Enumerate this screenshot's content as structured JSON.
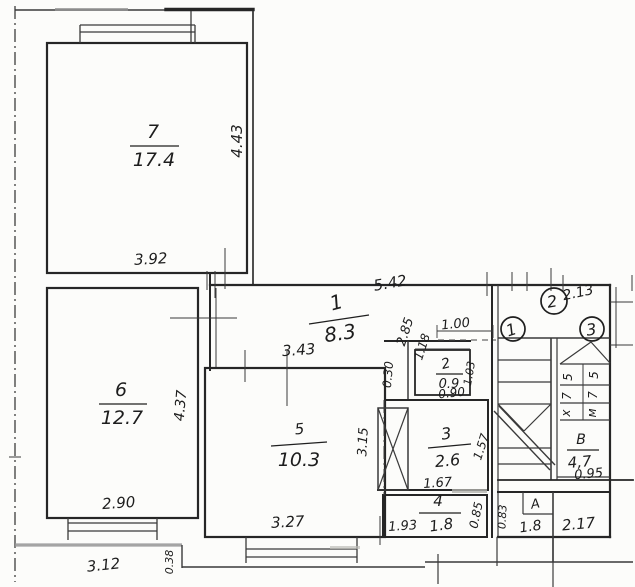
{
  "plan": {
    "type": "scanned hand-drawn apartment floor plan",
    "rooms": [
      {
        "number": "7",
        "area": "17.4"
      },
      {
        "number": "6",
        "area": "12.7"
      },
      {
        "number": "5",
        "area": "10.3"
      },
      {
        "number": "1",
        "area": "8.3"
      },
      {
        "number": "2",
        "area": "0.9"
      },
      {
        "number": "3",
        "area": "2.6"
      },
      {
        "number": "4",
        "area": "1.8"
      },
      {
        "number": "В",
        "area": "4,7"
      },
      {
        "number": "А",
        "area": "1.8"
      }
    ],
    "dimensions": {
      "room7_height": "4.43",
      "room7_width": "3.92",
      "room6_height": "4.37",
      "room6_width": "2.90",
      "outer_width_left": "3.12",
      "ledge": "0.38",
      "room5_width_top": "3.43",
      "room5_width_bottom": "3.27",
      "hall_width": "5.42",
      "hall_diag1": "2.85",
      "hall_diag2": "1.18",
      "room2_width_top": "1.00",
      "wall_niche": "0.30",
      "room2_width": "0.90",
      "room2_height": "1.03",
      "duct_height": "3.15",
      "room3_width": "1.67",
      "room3_height": "1.57",
      "room4_width": "1.93",
      "room4_height": "0.85",
      "landing_width": "2.13",
      "roomB_width": "0.95",
      "roomA_height": "0.83",
      "bottom_block_width": "2.17"
    },
    "markers": [
      "1",
      "2",
      "3"
    ],
    "stair_labels": {
      "left_flight": [
        "5",
        "7",
        "х"
      ],
      "right_flight": [
        "5",
        "7",
        "м"
      ]
    }
  }
}
